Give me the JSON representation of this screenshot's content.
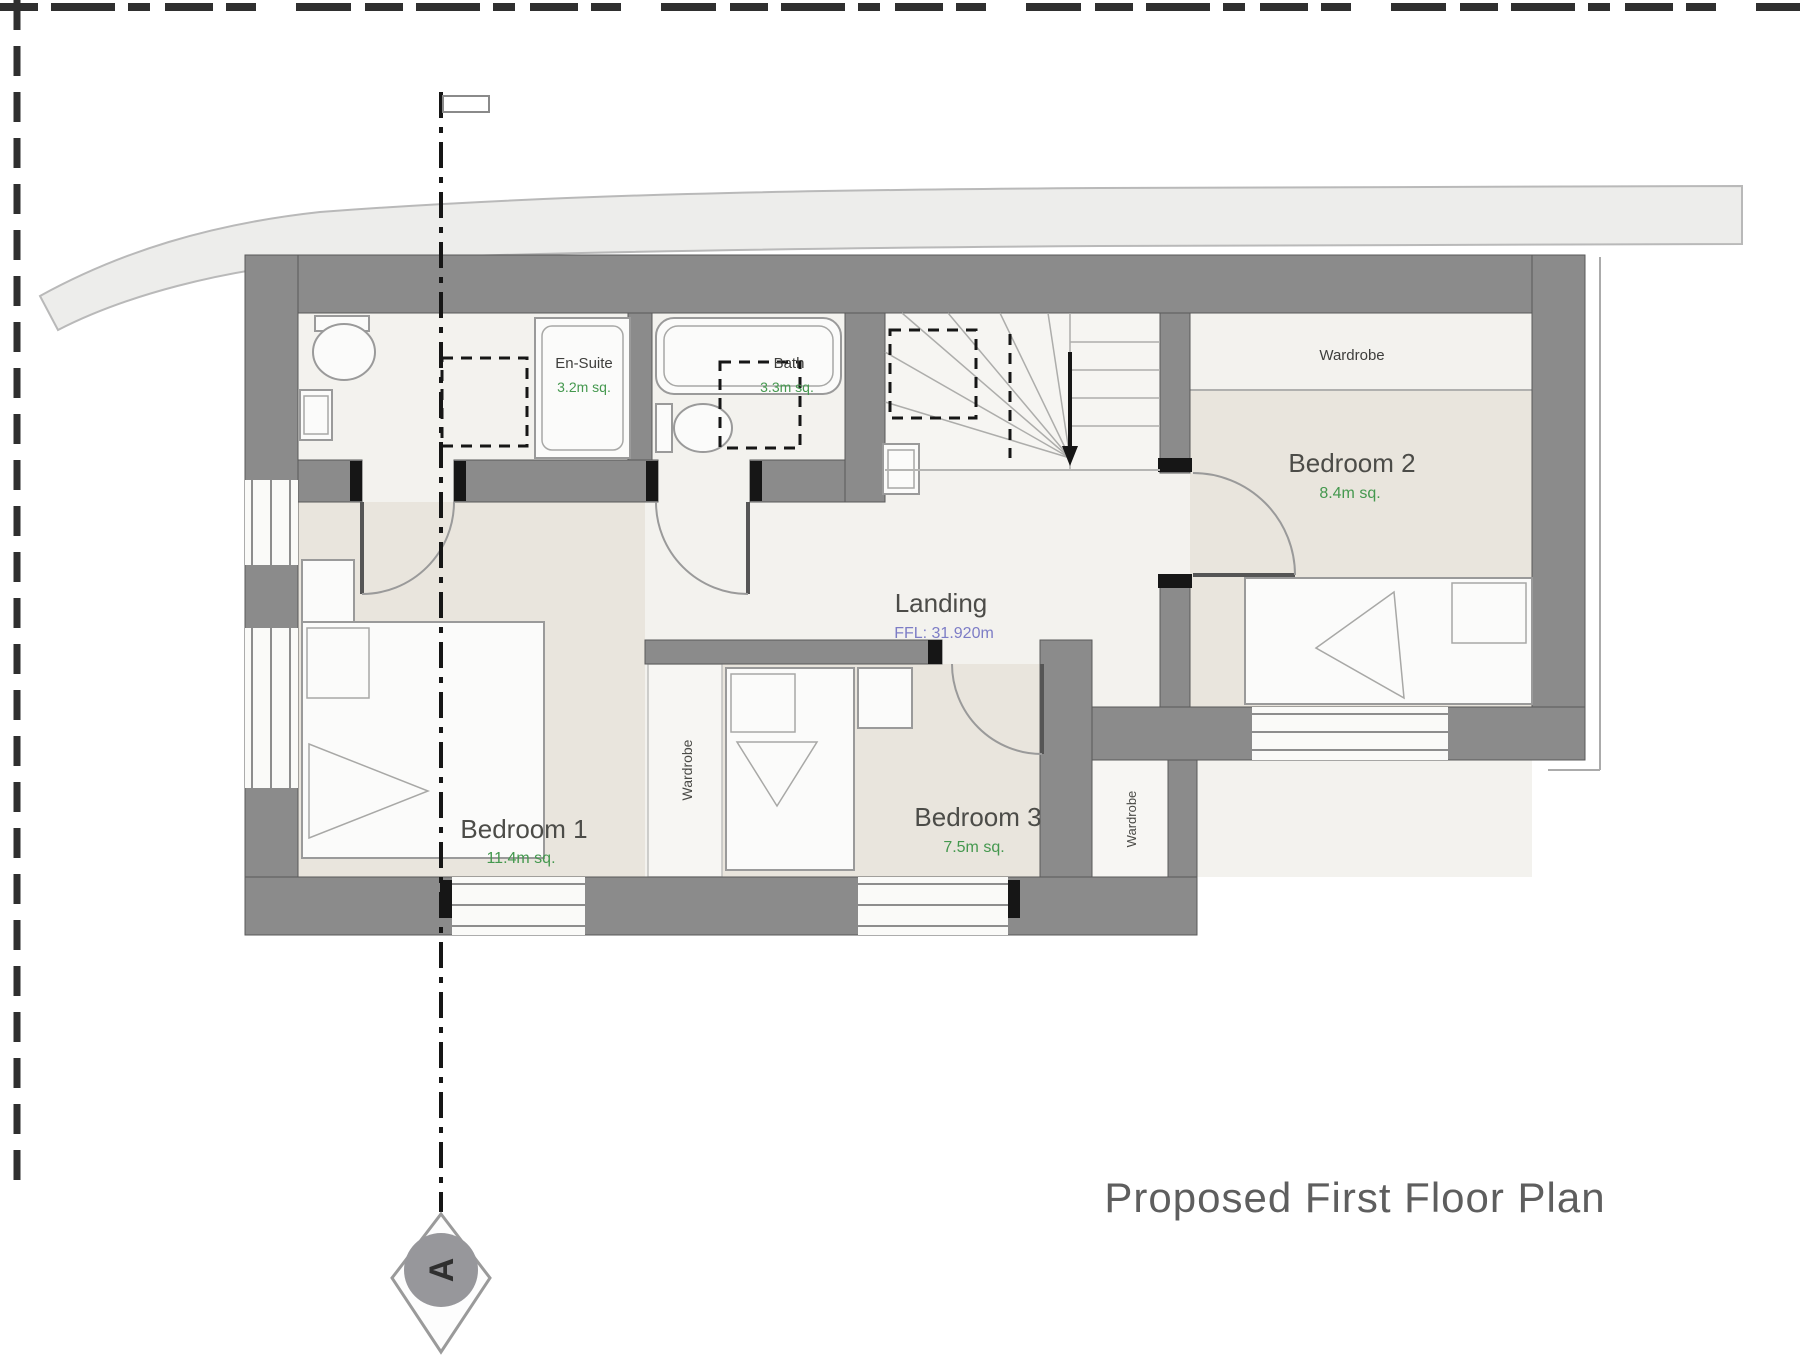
{
  "title": "Proposed First Floor Plan",
  "plan": {
    "rooms": {
      "bedroom1": {
        "name": "Bedroom 1",
        "area": "11.4m sq."
      },
      "bedroom2": {
        "name": "Bedroom 2",
        "area": "8.4m sq."
      },
      "bedroom3": {
        "name": "Bedroom 3",
        "area": "7.5m sq."
      },
      "en_suite": {
        "name": "En-Suite",
        "area": "3.2m sq."
      },
      "bath": {
        "name": "Bath",
        "area": "3.3m sq."
      },
      "landing": {
        "name": "Landing",
        "ffl": "FFL: 31.920m"
      }
    },
    "wardrobes": {
      "bedroom2": "Wardrobe",
      "middle": "Wardrobe",
      "extension": "Wardrobe"
    },
    "section_marker": {
      "letter": "A"
    }
  },
  "colors": {
    "wall_grey": "#8b8b8b",
    "floor_beige": "#e9e5dd",
    "floor_light": "#f3f2ee",
    "area_text_green": "#44984e",
    "ffl_text_purple": "#7d7dc6",
    "label_grey": "#4c4c48",
    "title_grey": "#5e5e5e"
  }
}
